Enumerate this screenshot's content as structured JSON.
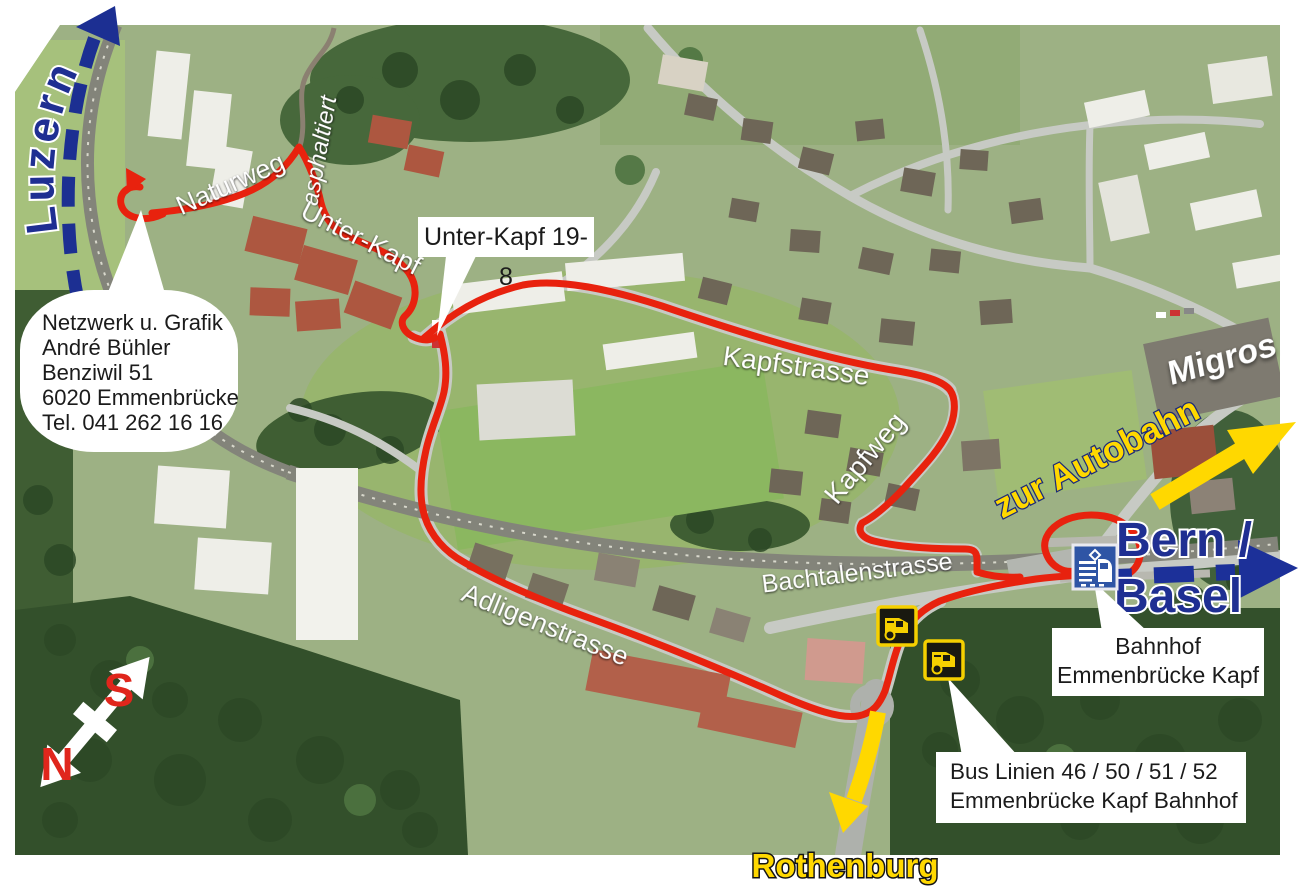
{
  "directions": {
    "luzern": "Luzern",
    "bern_basel_line1": "Bern /",
    "bern_basel_line2": "Basel",
    "rothenburg": "Rothenburg",
    "zur_autobahn": "zur Autobahn"
  },
  "streets": {
    "naturweg": "Naturweg",
    "asphaltiert": "asphaltiert",
    "unter_kapf": "Unter-Kapf",
    "kapfstrasse": "Kapfstrasse",
    "kapfweg": "Kapfweg",
    "bachtalenstrasse": "Bachtalenstrasse",
    "adligenstrasse": "Adligenstrasse"
  },
  "places": {
    "migros": "Migros"
  },
  "compass": {
    "south": "S",
    "north": "N"
  },
  "callouts": {
    "unter_kapf_number": "Unter-Kapf 19-8",
    "address_lines": [
      "Netzwerk u. Grafik",
      "André Bühler",
      "Benziwil 51",
      "6020 Emmenbrücke",
      "Tel. 041 262 16 16"
    ],
    "bahnhof_lines": [
      "Bahnhof",
      "Emmenbrücke Kapf"
    ],
    "bus_lines": [
      "Bus Linien 46 / 50 / 51 / 52",
      "Emmenbrücke Kapf Bahnhof"
    ]
  },
  "icons": {
    "station": "train-station-icon",
    "bus_stop": "bus-stop-icon"
  },
  "colors": {
    "route_red": "#e8220e",
    "direction_blue": "#1c2f92",
    "autobahn_yellow": "#ffd800",
    "compass_red": "#e0261c",
    "callout_bg": "#ffffff",
    "street_label": "#ffffff"
  }
}
